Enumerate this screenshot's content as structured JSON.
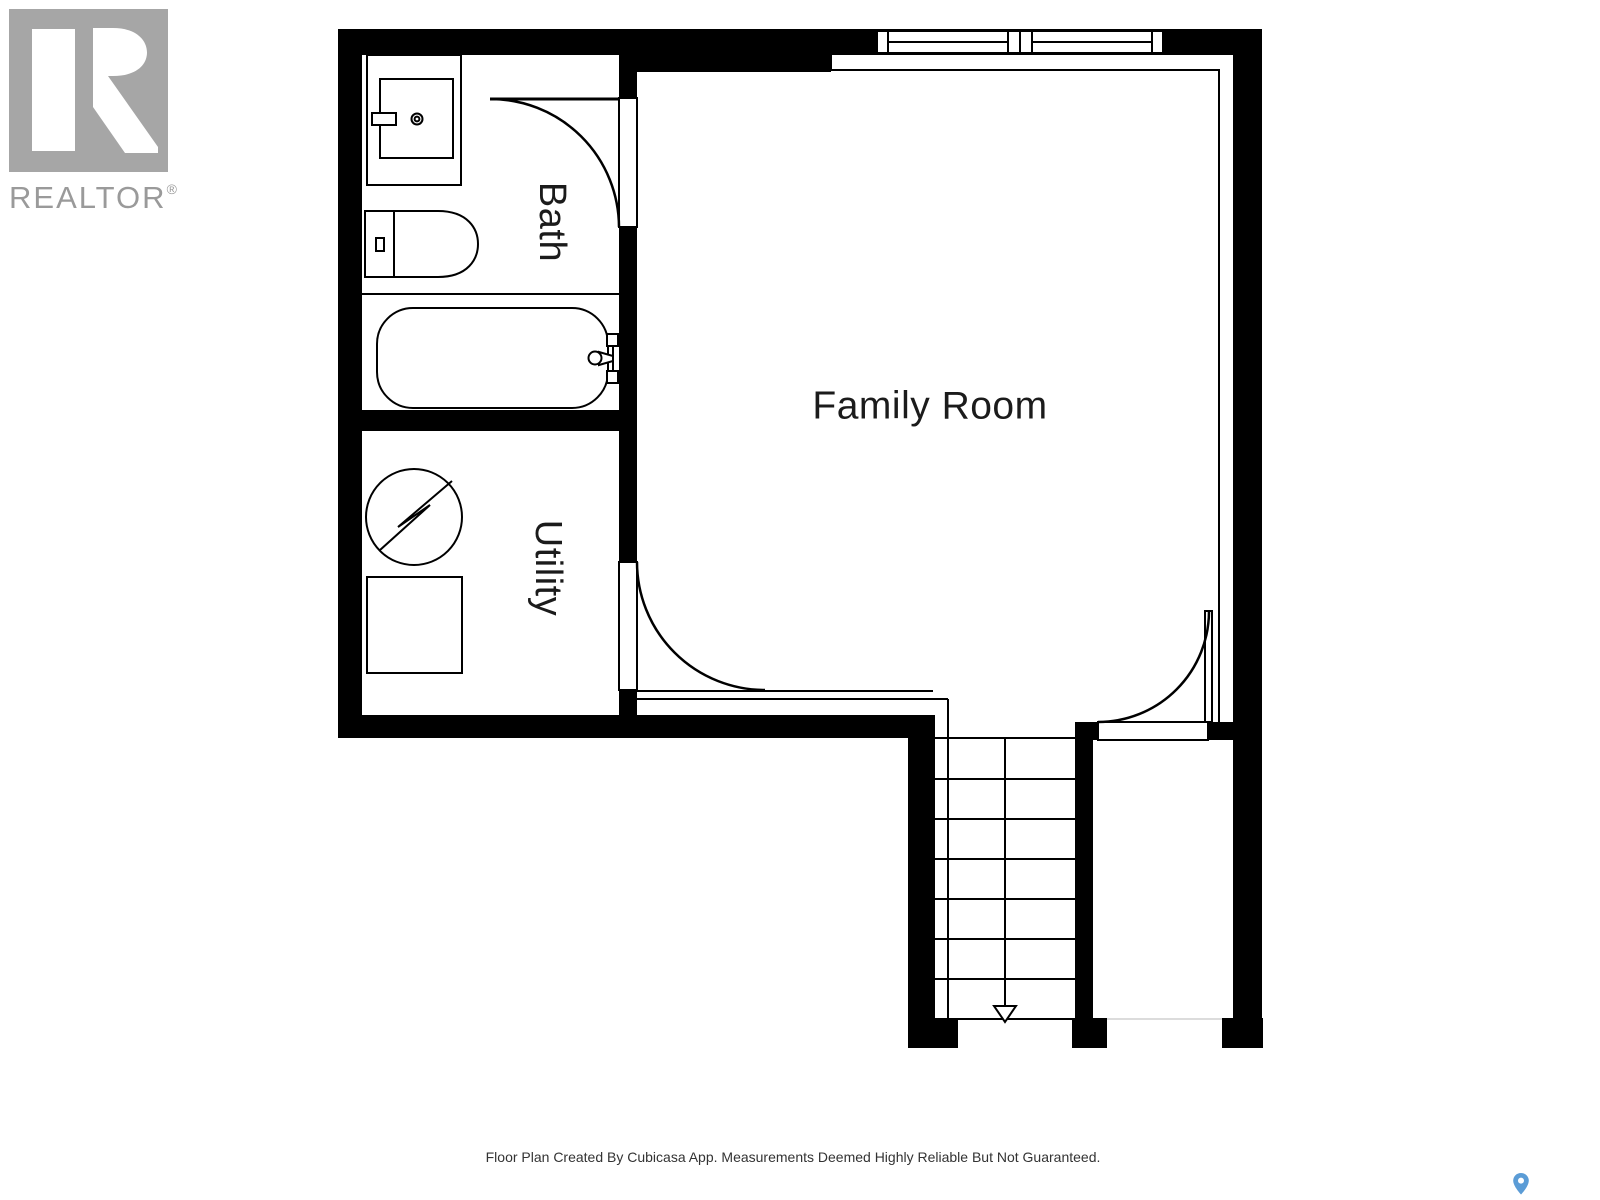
{
  "page": {
    "width": 1600,
    "height": 1200
  },
  "branding": {
    "logo_icon": "realtor-r-logo",
    "logo_text": "REALTOR",
    "reg_mark": "®"
  },
  "floor_plan": {
    "rooms": [
      {
        "label": "Bath",
        "label_orientation": "vertical",
        "fixtures": [
          "sink-vanity",
          "toilet",
          "bathtub"
        ]
      },
      {
        "label": "Utility",
        "label_orientation": "vertical",
        "fixtures": [
          "electrical-unit-circle",
          "appliance-square"
        ]
      },
      {
        "label": "Family Room",
        "label_orientation": "horizontal",
        "fixtures": []
      }
    ],
    "windows": [
      {
        "location": "top-wall-family-room",
        "panes": 2
      }
    ],
    "doors": [
      {
        "room": "Bath",
        "swing": "into-bath-from-family-room"
      },
      {
        "room": "Utility",
        "swing": "into-family-room"
      },
      {
        "room": "Family Room",
        "location": "bottom-right-landing",
        "swing": "into-family-room"
      }
    ],
    "stairs": {
      "direction": "down",
      "tread_lines": 8,
      "arrow": "down-arrow"
    }
  },
  "footer": {
    "disclaimer": "Floor Plan Created By Cubicasa App. Measurements Deemed Highly Reliable But Not Guaranteed."
  },
  "icons": {
    "map_pin": "map-pin-icon"
  },
  "colors": {
    "wall": "#000000",
    "line": "#000000",
    "logo_gray": "#a6a6a6",
    "logo_text_gray": "#9a9a9a",
    "label_text": "#1b1b1b",
    "footer_text": "#333333",
    "pin_blue": "#5b9cd6",
    "cut_line": "#dcdcdc",
    "background": "#ffffff"
  }
}
